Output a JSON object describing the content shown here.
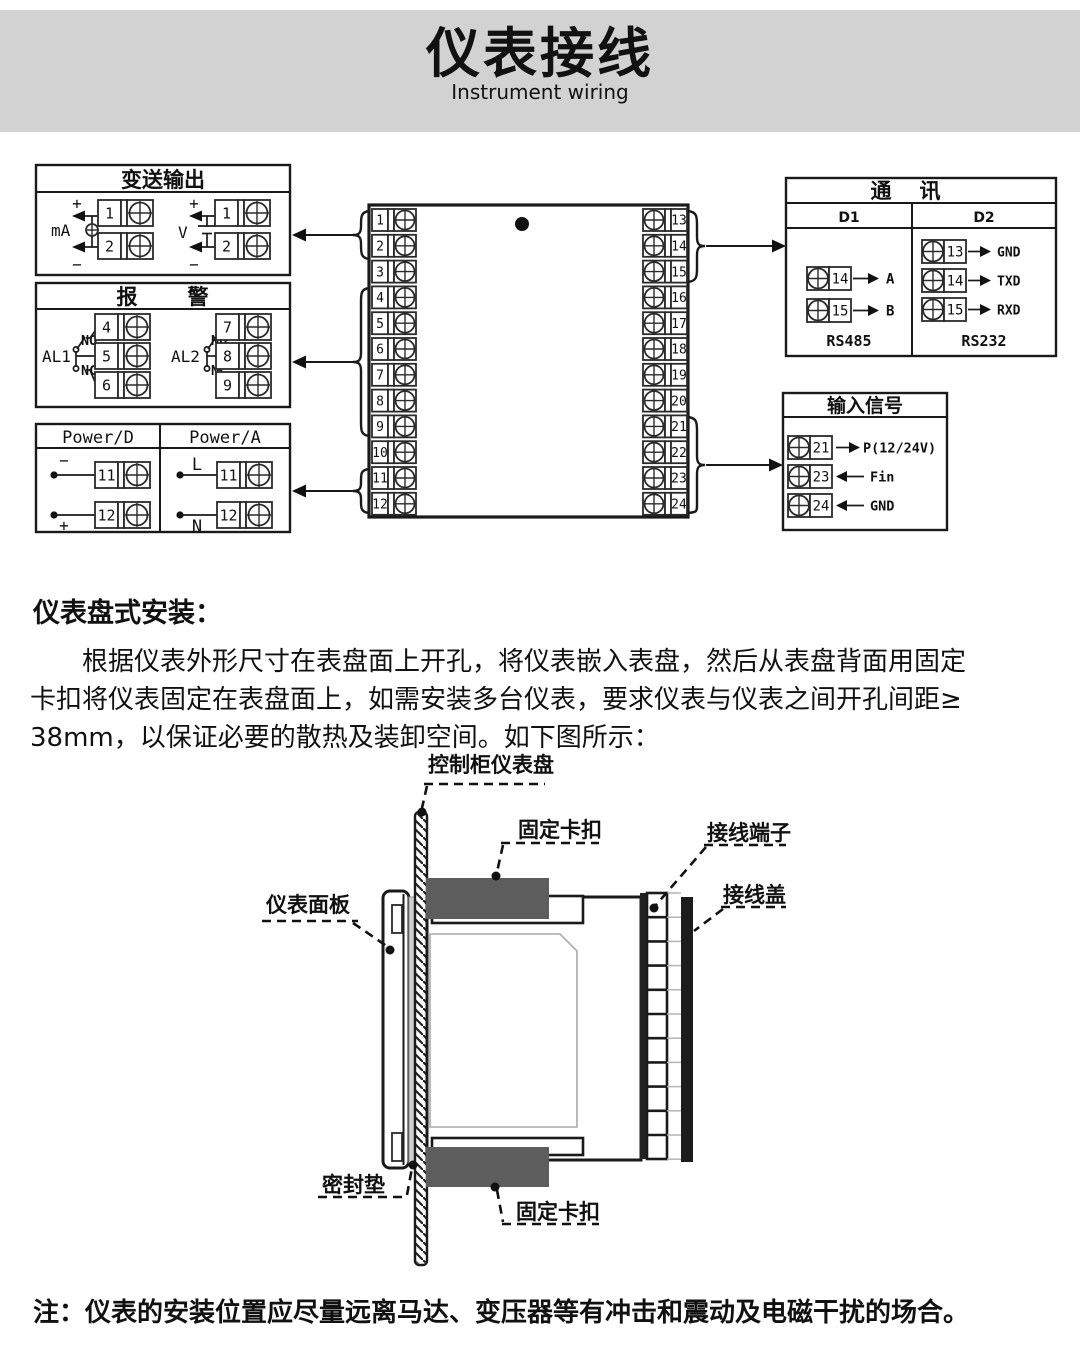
{
  "banner": {
    "title": "仪表接线",
    "subtitle": "Instrument wiring"
  },
  "wiring": {
    "transmission": {
      "title": "变送输出",
      "ma_label": "mA",
      "v_label": "V",
      "plus": "+",
      "minus": "−",
      "ma_terminals": [
        "1",
        "2"
      ],
      "v_terminals": [
        "1",
        "2"
      ]
    },
    "alarm": {
      "title_1": "报",
      "title_2": "警",
      "al1": "AL1",
      "al2": "AL2",
      "no": "NO",
      "nc": "NC",
      "al1_terminals": [
        "4",
        "5",
        "6"
      ],
      "al2_terminals": [
        "7",
        "8",
        "9"
      ]
    },
    "power": {
      "d_title": "Power/D",
      "a_title": "Power/A",
      "minus": "−",
      "plus": "+",
      "live": "L",
      "neutral": "N",
      "d_terminals": [
        "11",
        "12"
      ],
      "a_terminals": [
        "11",
        "12"
      ]
    },
    "terminal_block": {
      "left": [
        "1",
        "2",
        "3",
        "4",
        "5",
        "6",
        "7",
        "8",
        "9",
        "10",
        "11",
        "12"
      ],
      "right": [
        "13",
        "14",
        "15",
        "16",
        "17",
        "18",
        "19",
        "20",
        "21",
        "22",
        "23",
        "24"
      ]
    },
    "communication": {
      "title_1": "通",
      "title_2": "讯",
      "d1": "D1",
      "d2": "D2",
      "d1_rows": [
        {
          "num": "14",
          "label": "A"
        },
        {
          "num": "15",
          "label": "B"
        }
      ],
      "d1_footer": "RS485",
      "d2_rows": [
        {
          "num": "13",
          "label": "GND"
        },
        {
          "num": "14",
          "label": "TXD"
        },
        {
          "num": "15",
          "label": "RXD"
        }
      ],
      "d2_footer": "RS232"
    },
    "input_signal": {
      "title": "输入信号",
      "rows": [
        {
          "num": "21",
          "label": "P(12/24V)",
          "dir": "right"
        },
        {
          "num": "23",
          "label": "Fin",
          "dir": "left"
        },
        {
          "num": "24",
          "label": "GND",
          "dir": "left"
        }
      ]
    }
  },
  "installation": {
    "heading": "仪表盘式安装：",
    "paragraph_lines": [
      "根据仪表外形尺寸在表盘面上开孔，将仪表嵌入表盘，然后从表盘背面用固定",
      "卡扣将仪表固定在表盘面上，如需安装多台仪表，要求仪表与仪表之间开孔间距≥",
      "38mm，以保证必要的散热及装卸空间。如下图所示："
    ],
    "labels": {
      "cabinet_panel": "控制柜仪表盘",
      "fixing_clip_top": "固定卡扣",
      "terminal_block": "接线端子",
      "wiring_cover": "接线盖",
      "front_panel": "仪表面板",
      "gasket": "密封垫",
      "fixing_clip_bottom": "固定卡扣"
    }
  },
  "note": "注：仪表的安装位置应尽量远离马达、变压器等有冲击和震动及电磁干扰的场合。"
}
